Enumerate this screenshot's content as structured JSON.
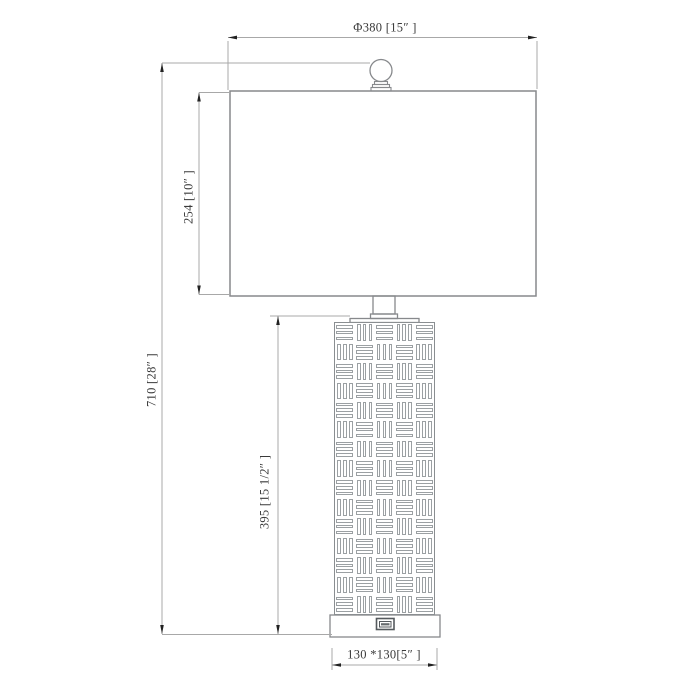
{
  "labels": {
    "shade_width": "Φ380 [15″ ]",
    "total_height": "710 [28″ ]",
    "shade_height": "254 [10″ ]",
    "body_height": "395 [15 1/2″ ]",
    "base_size": "130 *130[5″ ]"
  },
  "dimensions_mm": {
    "shade_width": 380,
    "total_height": 710,
    "shade_height": 254,
    "body_height": 395,
    "base_width": 130,
    "base_depth": 130
  },
  "dimensions_inches": {
    "shade_width": "15",
    "total_height": "28",
    "shade_height": "10",
    "body_height": "15 1/2",
    "base": "5"
  },
  "colors": {
    "background": "#ffffff",
    "outline": "#87898c",
    "dimension_line": "#a8a8a8",
    "arrow": "#222222",
    "text": "#3a3a3a"
  }
}
